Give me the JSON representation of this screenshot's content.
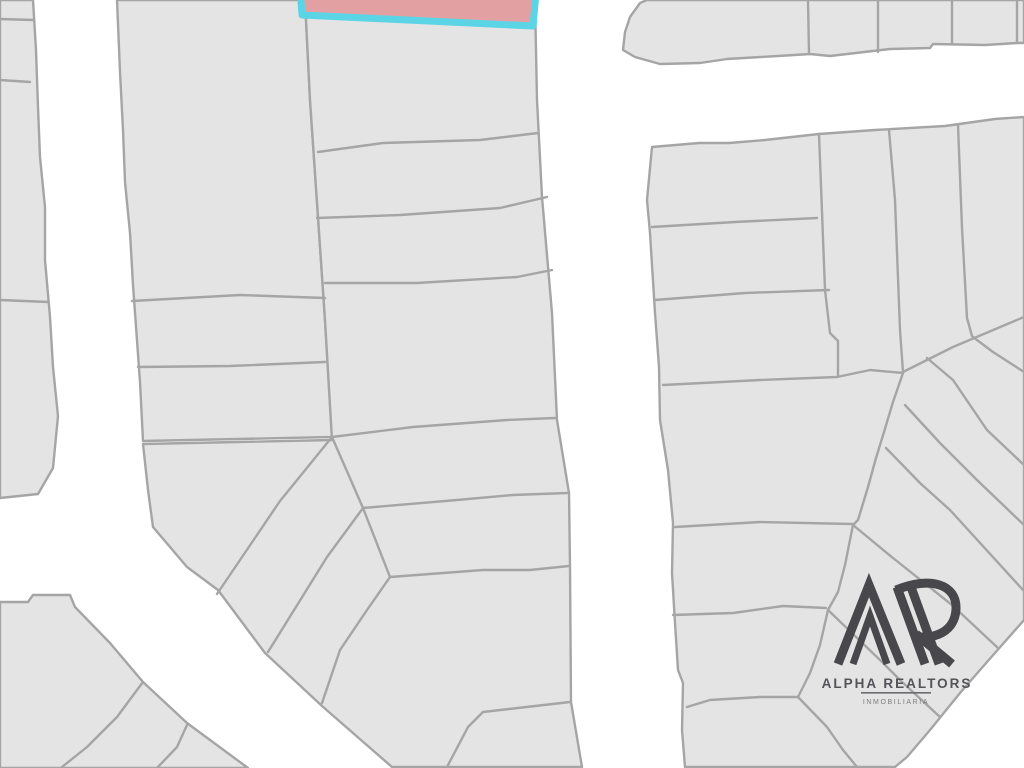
{
  "canvas": {
    "width": 1024,
    "height": 768,
    "background": "#ffffff"
  },
  "map": {
    "parcel_fill": "#e4e4e4",
    "parcel_stroke": "#a5a5a5",
    "parcel_stroke_width": 2.4,
    "blocks": [
      {
        "name": "block-left-sliver",
        "points": "0,0 33,0 36,50 38,107 40,157 45,207 45,260 50,317 53,367 58,416 53,468 38,494 0,498"
      },
      {
        "name": "block-top-middle",
        "points": "117,0 305,0 310,100 318,217 325,320 332,437 143,441 140,382 133,285 130,233 125,182 123,130 120,72"
      },
      {
        "name": "block-middle-right",
        "points": "305,0 535,0 537,100 542,197 552,313 557,420 569,493 570,566 571,702 582,767 392,767 322,706 265,653 218,590 187,567 153,527 148,490 143,444 332,440 325,320 318,217 310,100"
      },
      {
        "name": "block-bottom-left",
        "points": "0,602 28,602 33,595 70,595 75,607 110,643 143,682 187,723 248,768 0,768"
      },
      {
        "name": "block-top-right",
        "points": "647,0 1024,0 1024,43 1017,43 985,45 933,44 930,48 890,49 830,56 810,54 778,56 727,59 700,63 660,64 635,57 623,50 625,32 630,17 640,3"
      },
      {
        "name": "block-right-superblock",
        "points": "652,147 699,143 729,143 765,140 819,134 875,130 945,126 995,119 1024,117 1024,620 987,662 960,693 930,730 907,757 895,767 685,767 682,730 683,683 678,670 675,623 672,573 673,523 668,470 660,420 659,367 655,313 650,233 647,200"
      }
    ],
    "boundary_lines": [
      {
        "name": "lot-line-sliver-1",
        "points": "0,19 33,20"
      },
      {
        "name": "lot-line-sliver-2",
        "points": "0,80 30,82"
      },
      {
        "name": "lot-line-sliver-3",
        "points": "0,300 48,302"
      },
      {
        "name": "lot-line-midleft-1",
        "points": "132,301 240,295 325,298"
      },
      {
        "name": "lot-line-midleft-2",
        "points": "138,367 230,366 325,362"
      },
      {
        "name": "lot-line-midright-1",
        "points": "318,152 383,143 480,140 538,133"
      },
      {
        "name": "lot-line-midright-2",
        "points": "317,218 400,215 500,208 547,197"
      },
      {
        "name": "lot-line-midright-3",
        "points": "325,283 417,283 517,277 552,270"
      },
      {
        "name": "lot-line-midright-4",
        "points": "332,437 413,427 507,420 555,418"
      },
      {
        "name": "lot-line-midright-5",
        "points": "363,508 457,500 513,495 567,493"
      },
      {
        "name": "lot-line-midright-6",
        "points": "390,577 483,570 530,570 569,566"
      },
      {
        "name": "lot-line-midright-7",
        "points": "570,702 483,712 468,727 447,767"
      },
      {
        "name": "lot-chain-segment-1",
        "points": "332,437 363,508"
      },
      {
        "name": "lot-chain-segment-2",
        "points": "363,508 390,577"
      },
      {
        "name": "lot-diagonal-a",
        "points": "332,437 280,501 217,594"
      },
      {
        "name": "lot-diagonal-b",
        "points": "363,508 327,557 268,652"
      },
      {
        "name": "lot-diagonal-c",
        "points": "390,577 367,610 340,650 322,703"
      },
      {
        "name": "lot-line-bottomleft-1",
        "points": "143,682 117,717 87,747 62,767"
      },
      {
        "name": "lot-line-bottomleft-2",
        "points": "187,725 177,747 157,768"
      },
      {
        "name": "lot-line-topright-v1",
        "points": "808,0 809,54"
      },
      {
        "name": "lot-line-topright-v2",
        "points": "878,0 878,52"
      },
      {
        "name": "lot-line-topright-v3",
        "points": "952,0 952,44"
      },
      {
        "name": "lot-line-topright-v4",
        "points": "1017,0 1017,43"
      },
      {
        "name": "lot-row-superblock-1",
        "points": "652,227 735,222 817,218"
      },
      {
        "name": "lot-row-superblock-2",
        "points": "655,300 745,293 829,290"
      },
      {
        "name": "lot-row-superblock-3",
        "points": "663,385 760,380 837,377 870,370 903,373"
      },
      {
        "name": "lot-row-superblock-4",
        "points": "675,527 760,522 852,524"
      },
      {
        "name": "lot-row-superblock-5",
        "points": "673,615 733,613 783,606 826,608"
      },
      {
        "name": "lot-row-superblock-6",
        "points": "687,707 710,700 760,697 798,697"
      },
      {
        "name": "lot-vertical-superblock-1",
        "points": "819,134 825,290 830,333 838,341 838,375"
      },
      {
        "name": "lot-vertical-superblock-2",
        "points": "889,130 895,200 900,330 903,372"
      },
      {
        "name": "lot-vertical-superblock-3",
        "points": "958,125 962,228 967,318 972,336"
      },
      {
        "name": "lot-fan-top-boundary",
        "points": "903,372 953,347 1024,317"
      },
      {
        "name": "lot-fan-arc",
        "points": "903,373 893,402 884,432 876,458 868,487 858,520 853,525 845,565 838,592 828,610 820,645 810,673 798,697"
      },
      {
        "name": "lot-fan-diagonal-1",
        "points": "973,337 993,352 1024,372"
      },
      {
        "name": "lot-fan-diagonal-2",
        "points": "927,358 953,380 987,430 1024,465"
      },
      {
        "name": "lot-fan-diagonal-3",
        "points": "905,405 940,443 977,480 1024,525"
      },
      {
        "name": "lot-fan-diagonal-4",
        "points": "886,448 920,483 950,510 1023,590"
      },
      {
        "name": "lot-fan-diagonal-5",
        "points": "853,525 893,558 952,605 998,648"
      },
      {
        "name": "lot-fan-diagonal-6",
        "points": "828,610 880,660 900,680 940,717"
      },
      {
        "name": "lot-fan-diagonal-7",
        "points": "798,697 827,727 843,750 857,767"
      }
    ],
    "highlight_parcel": {
      "name": "highlighted-lot",
      "points": "300,-12 537,-18 533,26 302,15",
      "fill": "#e3a0a2",
      "stroke": "#5bd5e6",
      "stroke_width": 7
    }
  },
  "logo": {
    "title": "ALPHA REALTORS",
    "subtitle": "INMOBILIARIA",
    "mark_color": "#48474b",
    "text_color": "#545358",
    "rule_color": "#6b6a6e",
    "monogram_strokes": [
      {
        "name": "mono-a-outer",
        "d": "M838,664 L869,585 L901,664",
        "width": 9
      },
      {
        "name": "mono-a-inner",
        "d": "M853,664 L870,616 L887,664",
        "width": 7
      },
      {
        "name": "mono-r-slash-1",
        "d": "M897,587 L925,664",
        "width": 9
      },
      {
        "name": "mono-r-slash-2",
        "d": "M911,587 L939,664",
        "width": 9
      },
      {
        "name": "mono-r-bowl",
        "d": "M896,590 C930,576 957,584 956,609 C955,633 932,640 914,636",
        "width": 9
      },
      {
        "name": "mono-r-tail",
        "d": "M916,634 L952,664",
        "width": 9
      }
    ]
  }
}
